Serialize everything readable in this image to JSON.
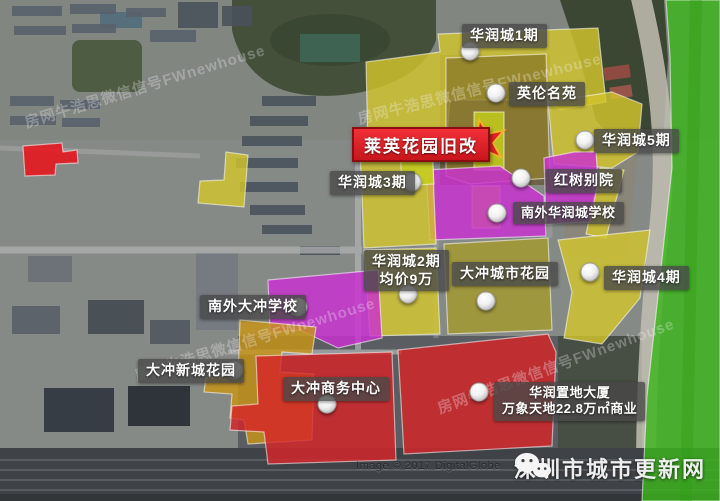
{
  "watermark": "房网牛浩思微信信号FWnewhouse",
  "footer": {
    "copyright": "Image © 2017 DigitalGlobe",
    "branding": "深圳市城市更新网",
    "branding_icon": "wechat-icon"
  },
  "highlight": {
    "label": "莱英花园旧改",
    "marker": "red-star"
  },
  "labels": [
    {
      "id": "huarun-city-1",
      "line1": "华润城1期"
    },
    {
      "id": "yinglun-mingyuan",
      "line1": "英伦名苑"
    },
    {
      "id": "huarun-city-5",
      "line1": "华润城5期"
    },
    {
      "id": "huarun-city-3",
      "line1": "华润城3期"
    },
    {
      "id": "hongshu-bieyuan",
      "line1": "红树别院"
    },
    {
      "id": "nanwai-huaruncheng-school",
      "line1": "南外华润城学校"
    },
    {
      "id": "huarun-city-2",
      "line1": "华润城2期",
      "line2": "均价9万"
    },
    {
      "id": "dachong-city-garden",
      "line1": "大冲城市花园"
    },
    {
      "id": "huarun-city-4",
      "line1": "华润城4期"
    },
    {
      "id": "nanwai-dachong-school",
      "line1": "南外大冲学校"
    },
    {
      "id": "dachong-xincheng-garden",
      "line1": "大冲新城花园"
    },
    {
      "id": "dachong-business-center",
      "line1": "大冲商务中心"
    },
    {
      "id": "huarun-zhidi-tower",
      "line1": "华润置地大厦",
      "line2": "万象天地22.8万㎡商业"
    }
  ],
  "colors": {
    "yellow": "#d2c42d",
    "bright_yellow": "#c6cf1d",
    "olive": "#8f7e2c",
    "olive_light": "#a59a2e",
    "magenta": "#cb2fd2",
    "red_zone": "#d52528",
    "red_parcel": "#e31b22",
    "gold": "#c89417",
    "green_belt": "#3cb51c",
    "highlight_bg": "#e62129",
    "star_red": "#e2231f",
    "star_gold": "#f0b428"
  }
}
